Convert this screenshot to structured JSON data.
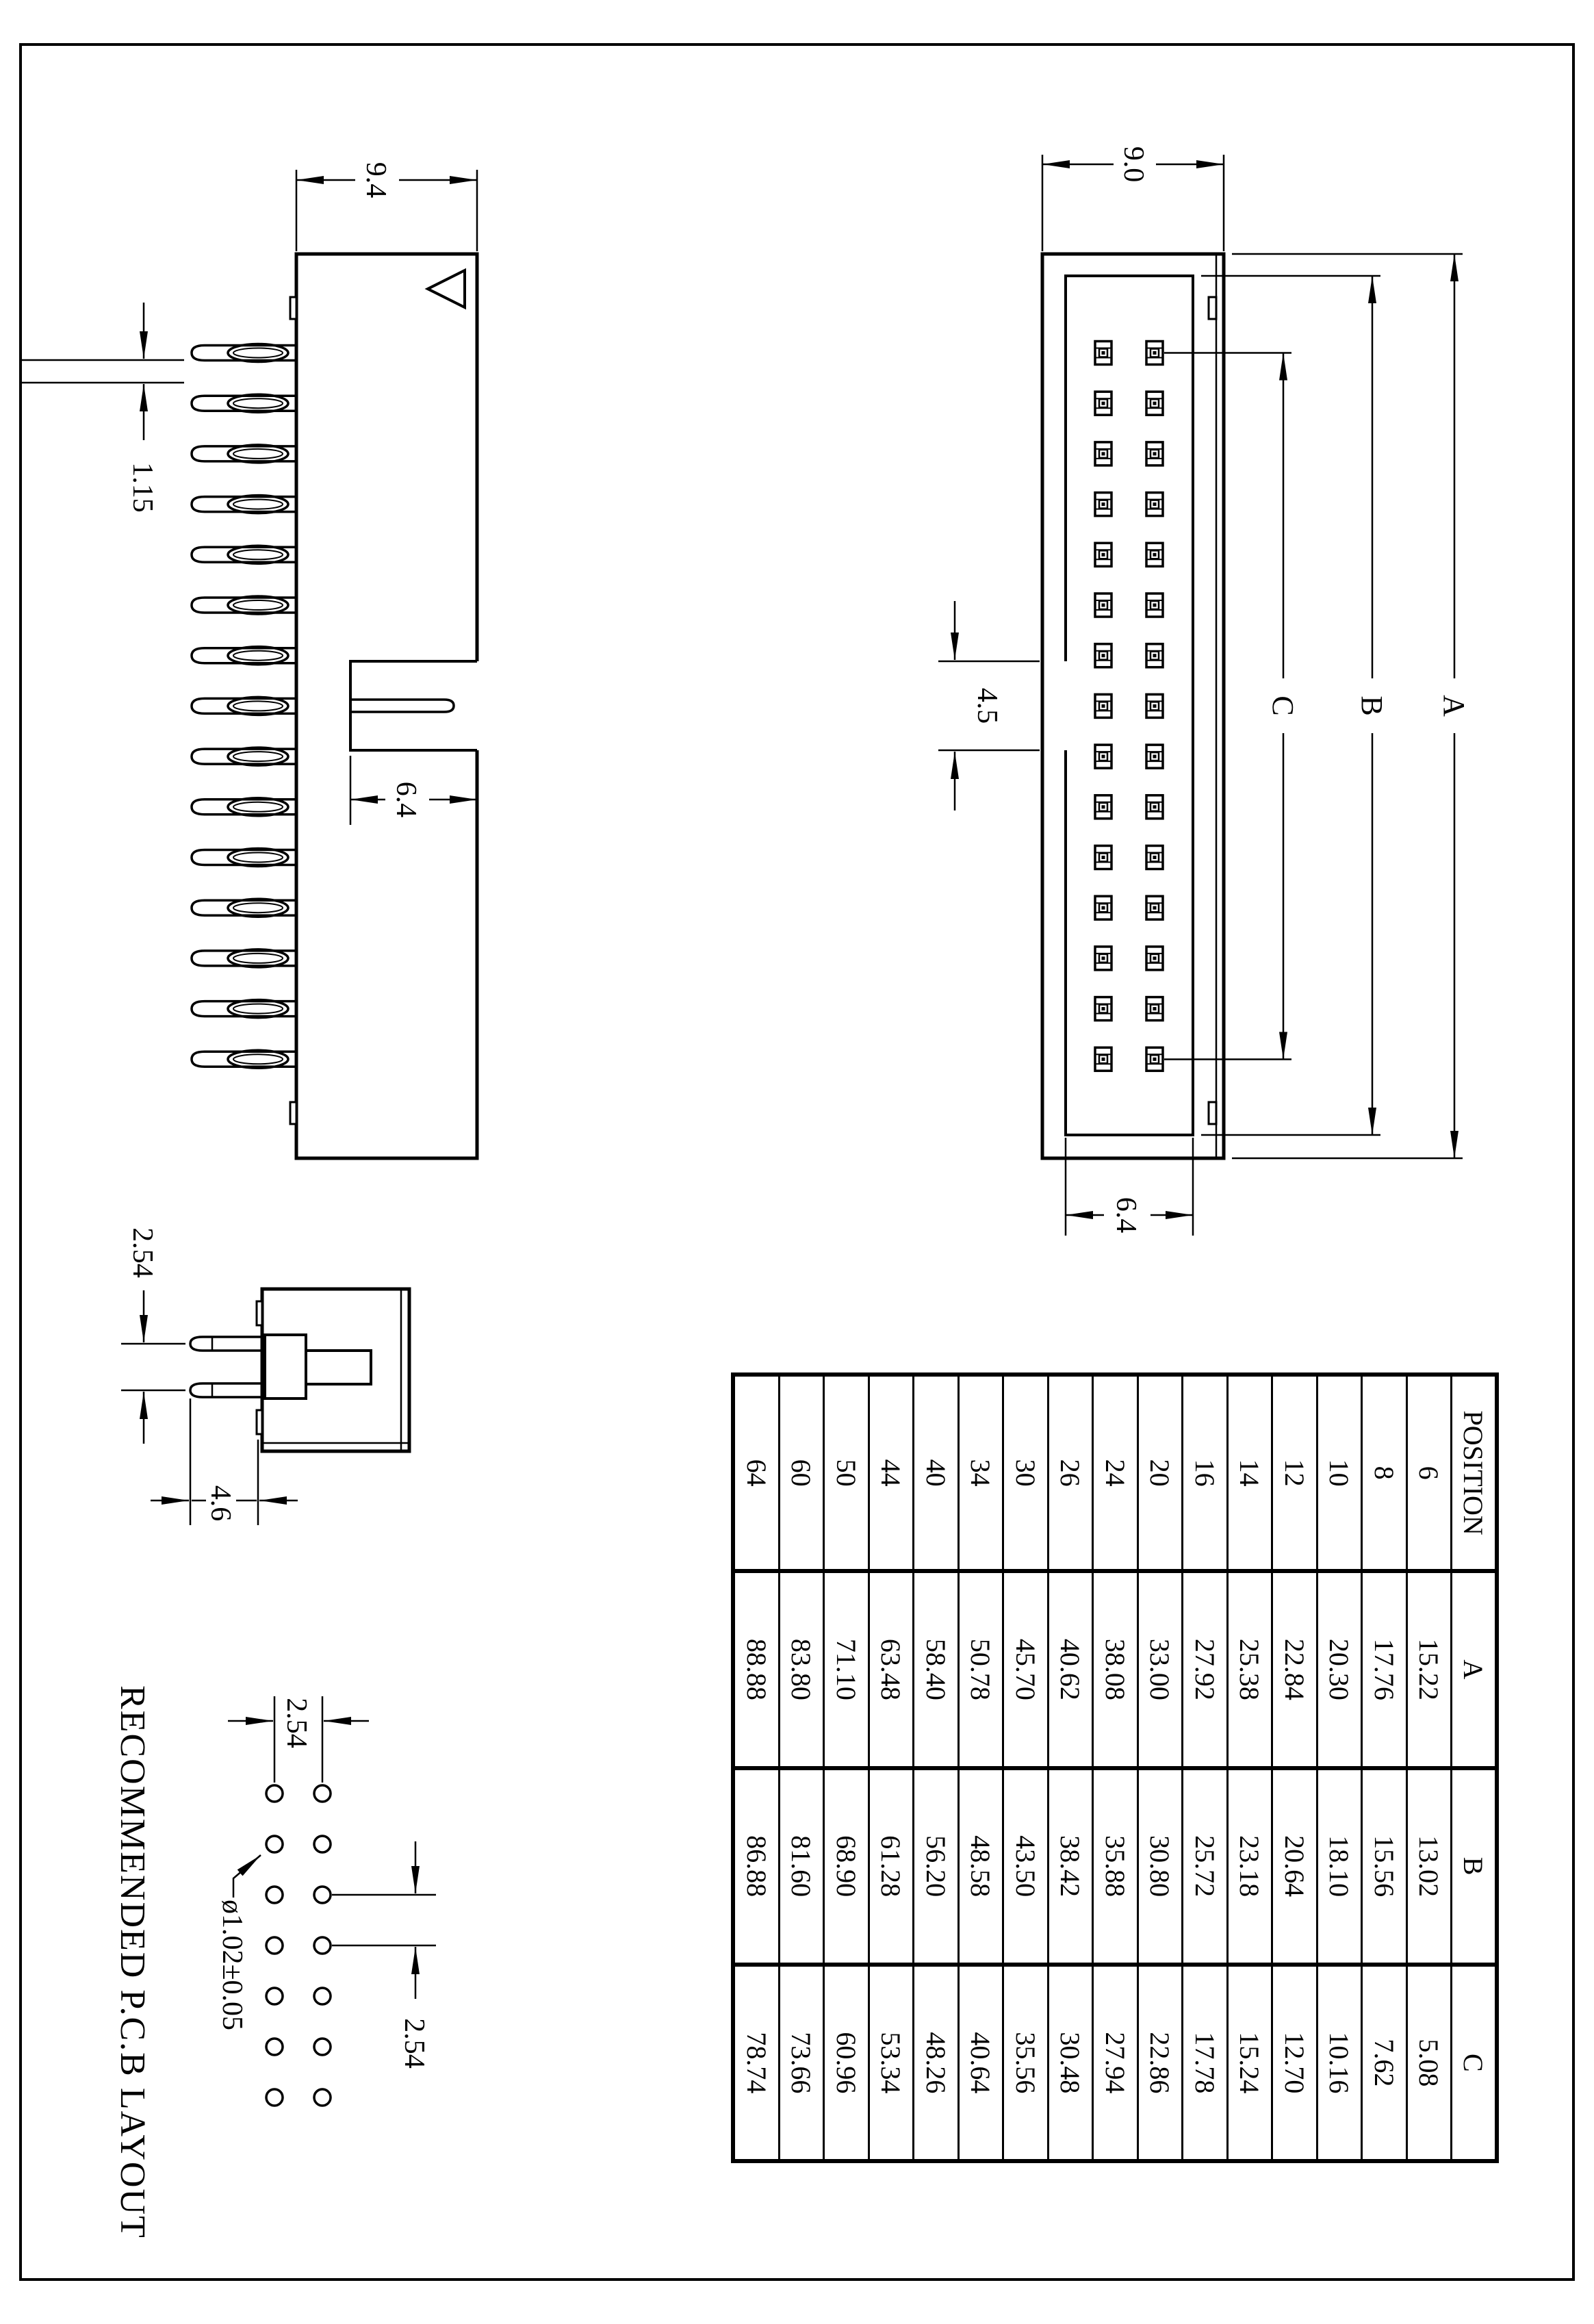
{
  "drawing": {
    "top_view": {
      "labels": {
        "body_width": "9.0",
        "cavity_width": "6.4",
        "key_slot_width": "4.5",
        "overall_length": "A",
        "inner_length": "B",
        "pin_span": "C"
      },
      "pin_columns": 15,
      "pin_rows": 2
    },
    "side_view": {
      "labels": {
        "body_depth": "9.4",
        "slot_depth": "6.4",
        "pin_thickness": "1.15"
      },
      "pin_count": 15
    },
    "front_view": {
      "labels": {
        "pin_pitch": "2.54",
        "pin_length": "4.6"
      }
    },
    "pcb_layout": {
      "title": "RECOMMENDED P.C.B LAYOUT",
      "labels": {
        "row_pitch": "2.54",
        "column_pitch": "2.54",
        "hole_diameter": "ø1.02±0.05"
      },
      "hole_columns": 7,
      "hole_rows": 2
    }
  },
  "table": {
    "headers": [
      "POSITION",
      "A",
      "B",
      "C"
    ],
    "rows": [
      {
        "position": "6",
        "a": "15.22",
        "b": "13.02",
        "c": "5.08"
      },
      {
        "position": "8",
        "a": "17.76",
        "b": "15.56",
        "c": "7.62"
      },
      {
        "position": "10",
        "a": "20.30",
        "b": "18.10",
        "c": "10.16"
      },
      {
        "position": "12",
        "a": "22.84",
        "b": "20.64",
        "c": "12.70"
      },
      {
        "position": "14",
        "a": "25.38",
        "b": "23.18",
        "c": "15.24"
      },
      {
        "position": "16",
        "a": "27.92",
        "b": "25.72",
        "c": "17.78"
      },
      {
        "position": "20",
        "a": "33.00",
        "b": "30.80",
        "c": "22.86"
      },
      {
        "position": "24",
        "a": "38.08",
        "b": "35.88",
        "c": "27.94"
      },
      {
        "position": "26",
        "a": "40.62",
        "b": "38.42",
        "c": "30.48"
      },
      {
        "position": "30",
        "a": "45.70",
        "b": "43.50",
        "c": "35.56"
      },
      {
        "position": "34",
        "a": "50.78",
        "b": "48.58",
        "c": "40.64"
      },
      {
        "position": "40",
        "a": "58.40",
        "b": "56.20",
        "c": "48.26"
      },
      {
        "position": "44",
        "a": "63.48",
        "b": "61.28",
        "c": "53.34"
      },
      {
        "position": "50",
        "a": "71.10",
        "b": "68.90",
        "c": "60.96"
      },
      {
        "position": "60",
        "a": "83.80",
        "b": "81.60",
        "c": "73.66"
      },
      {
        "position": "64",
        "a": "88.88",
        "b": "86.88",
        "c": "78.74"
      }
    ]
  }
}
